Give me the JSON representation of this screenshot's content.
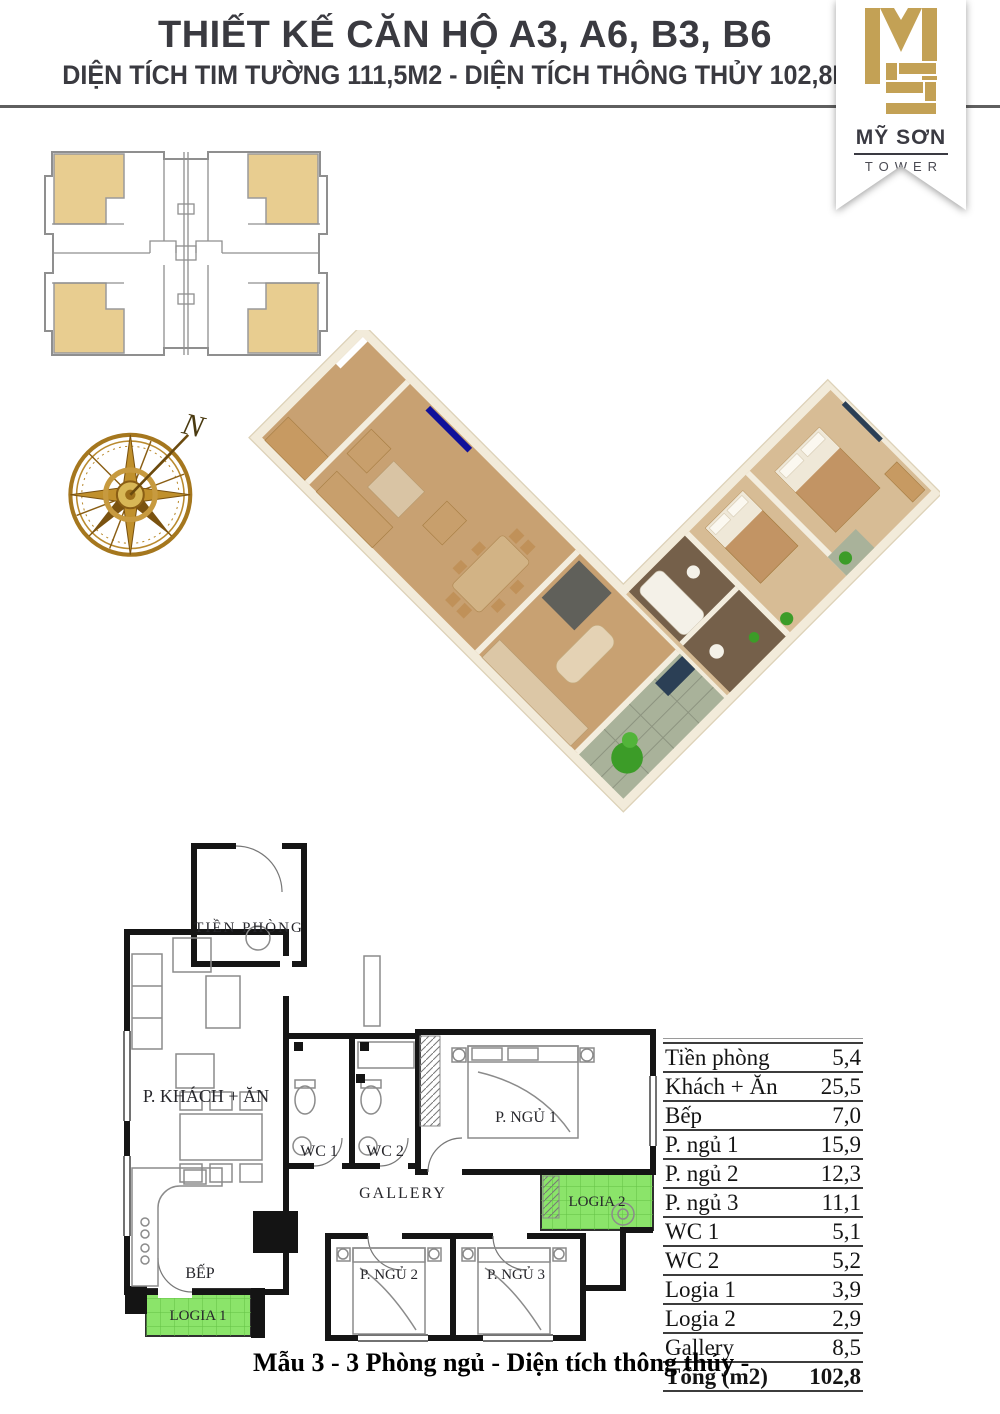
{
  "header": {
    "title": "THIẾT KẾ CĂN HỘ A3, A6, B3, B6",
    "subtitle": "DIỆN TÍCH TIM TƯỜNG 111,5M2 - DIỆN TÍCH THÔNG THỦY 102,8M2"
  },
  "logo": {
    "m": "M",
    "s": "S",
    "name": "MỸ SƠN",
    "sub": "TOWER"
  },
  "compass": {
    "north": "N"
  },
  "plan2d": {
    "labels": {
      "hall": "TIỀN PHÒNG",
      "living": "P. KHÁCH + ĂN",
      "wc1": "WC 1",
      "wc2": "WC 2",
      "bed1": "P. NGỦ 1",
      "gallery": "GALLERY",
      "kitchen": "BẾP",
      "logia1": "LOGIA 1",
      "bed2": "P. NGỦ 2",
      "bed3": "P. NGỦ 3",
      "logia2": "LOGIA 2"
    }
  },
  "table": {
    "rows": [
      {
        "label": "Tiền phòng",
        "value": "5,4"
      },
      {
        "label": "Khách + Ăn",
        "value": "25,5"
      },
      {
        "label": "Bếp",
        "value": "7,0"
      },
      {
        "label": "P. ngủ 1",
        "value": "15,9"
      },
      {
        "label": "P. ngủ 2",
        "value": "12,3"
      },
      {
        "label": "P. ngủ 3",
        "value": "11,1"
      },
      {
        "label": "WC 1",
        "value": "5,1"
      },
      {
        "label": "WC 2",
        "value": "5,2"
      },
      {
        "label": "Logia 1",
        "value": "3,9"
      },
      {
        "label": "Logia 2",
        "value": "2,9"
      },
      {
        "label": "Gallery",
        "value": "8,5"
      },
      {
        "label": "Tổng (m2)",
        "value": "102,8"
      }
    ]
  },
  "caption": "Mẫu 3 - 3 Phòng ngủ - Diện tích thông thủy -",
  "colors": {
    "gold": "#C3A155",
    "tan": "#E8CD90",
    "green": "#8BE46A",
    "header_text": "#3A3A40"
  }
}
